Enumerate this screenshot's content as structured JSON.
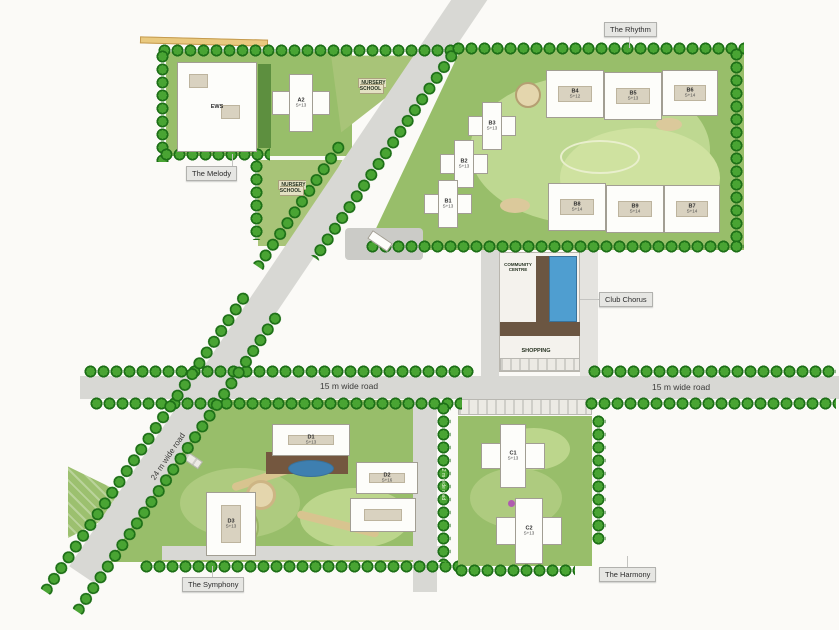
{
  "areas": {
    "melody": {
      "label": "The Melody"
    },
    "rhythm": {
      "label": "The Rhythm"
    },
    "club": {
      "label": "Club Chorus"
    },
    "symphony": {
      "label": "The Symphony"
    },
    "harmony": {
      "label": "The Harmony"
    }
  },
  "roads": {
    "r15_left": {
      "label": "15 m wide road"
    },
    "r15_right": {
      "label": "15 m wide road"
    },
    "r24": {
      "label": "24 m wide road"
    },
    "r12": {
      "label": "12 m wide road"
    }
  },
  "facilities": {
    "nursery_top": {
      "label": "NURSERY SCHOOL"
    },
    "nursery_lower": {
      "label": "NURSERY SCHOOL"
    },
    "community": {
      "label": "COMMUNITY CENTRE"
    },
    "shopping": {
      "label": "SHOPPING"
    },
    "ews": {
      "label": "EWS"
    }
  },
  "buildings": {
    "a2": {
      "code": "A2",
      "floors": "S+13"
    },
    "b1": {
      "code": "B1",
      "floors": "S+13"
    },
    "b2": {
      "code": "B2",
      "floors": "S+13"
    },
    "b3": {
      "code": "B3",
      "floors": "S+13"
    },
    "b4": {
      "code": "B4",
      "floors": "S+12"
    },
    "b5": {
      "code": "B5",
      "floors": "S+13"
    },
    "b6": {
      "code": "B6",
      "floors": "S+14"
    },
    "b7": {
      "code": "B7",
      "floors": "S+14"
    },
    "b8": {
      "code": "B8",
      "floors": "S+14"
    },
    "b9": {
      "code": "B9",
      "floors": "S+14"
    },
    "c1": {
      "code": "C1",
      "floors": "S+13"
    },
    "c2": {
      "code": "C2",
      "floors": "S+13"
    },
    "d1": {
      "code": "D1",
      "floors": "S+13"
    },
    "d2": {
      "code": "D2",
      "floors": "S+16"
    },
    "d3": {
      "code": "D3",
      "floors": "S+13"
    }
  },
  "colors": {
    "lawn": "#98be6a",
    "lawn_light": "#bed891",
    "tree_dark": "#1d6f17",
    "tree_mid": "#49a433",
    "road": "#d8d8d4",
    "building": "#fdfdfa",
    "pool": "#4f9ed0",
    "label_bg": "#e6e6e3"
  }
}
